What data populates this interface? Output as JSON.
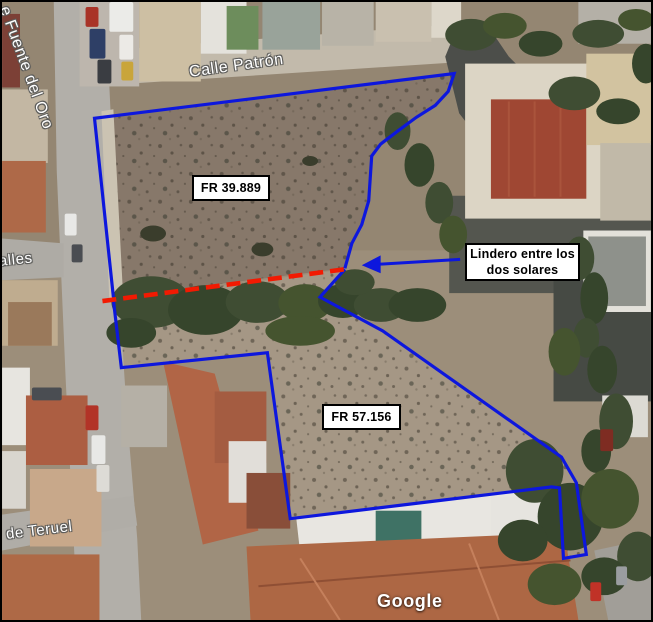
{
  "window": {
    "frame_color": "#000000"
  },
  "map": {
    "type": "satellite-imagery",
    "attribution": "Google",
    "street_labels": [
      {
        "name": "fuente-del-oro",
        "text": "e Fuente del Oro"
      },
      {
        "name": "calle-patron",
        "text": "Calle Patrón"
      },
      {
        "name": "calle-alles-partial",
        "text": "alles"
      },
      {
        "name": "de-teruel",
        "text": "de Teruel"
      }
    ]
  },
  "annotations": {
    "colors": {
      "parcel_outline": "#0d17dd",
      "boundary_line": "#f21a02",
      "label_background": "#ffffff",
      "label_border": "#000000",
      "label_text": "#000000"
    },
    "parcels": [
      {
        "label": "FR 39.889",
        "points": "112,297 93,117 455,72 449,90 436,104 417,116 398,130 381,143 372,155 369,200 362,224 352,243 345,268"
      },
      {
        "label": "FR 57.156",
        "points": "345,269 320,297 383,331 563,458 578,484 588,556 565,560 561,489 553,488 430,503 290,520 267,353 120,368 112,300"
      }
    ],
    "boundary": {
      "note_line1": "Lindero entre los",
      "note_line2": "dos solares",
      "line_points": "101,301 345,269",
      "arrow_line_points": "461,259 378,264",
      "arrow_head_points": "362,265 381,255 381,273"
    }
  }
}
